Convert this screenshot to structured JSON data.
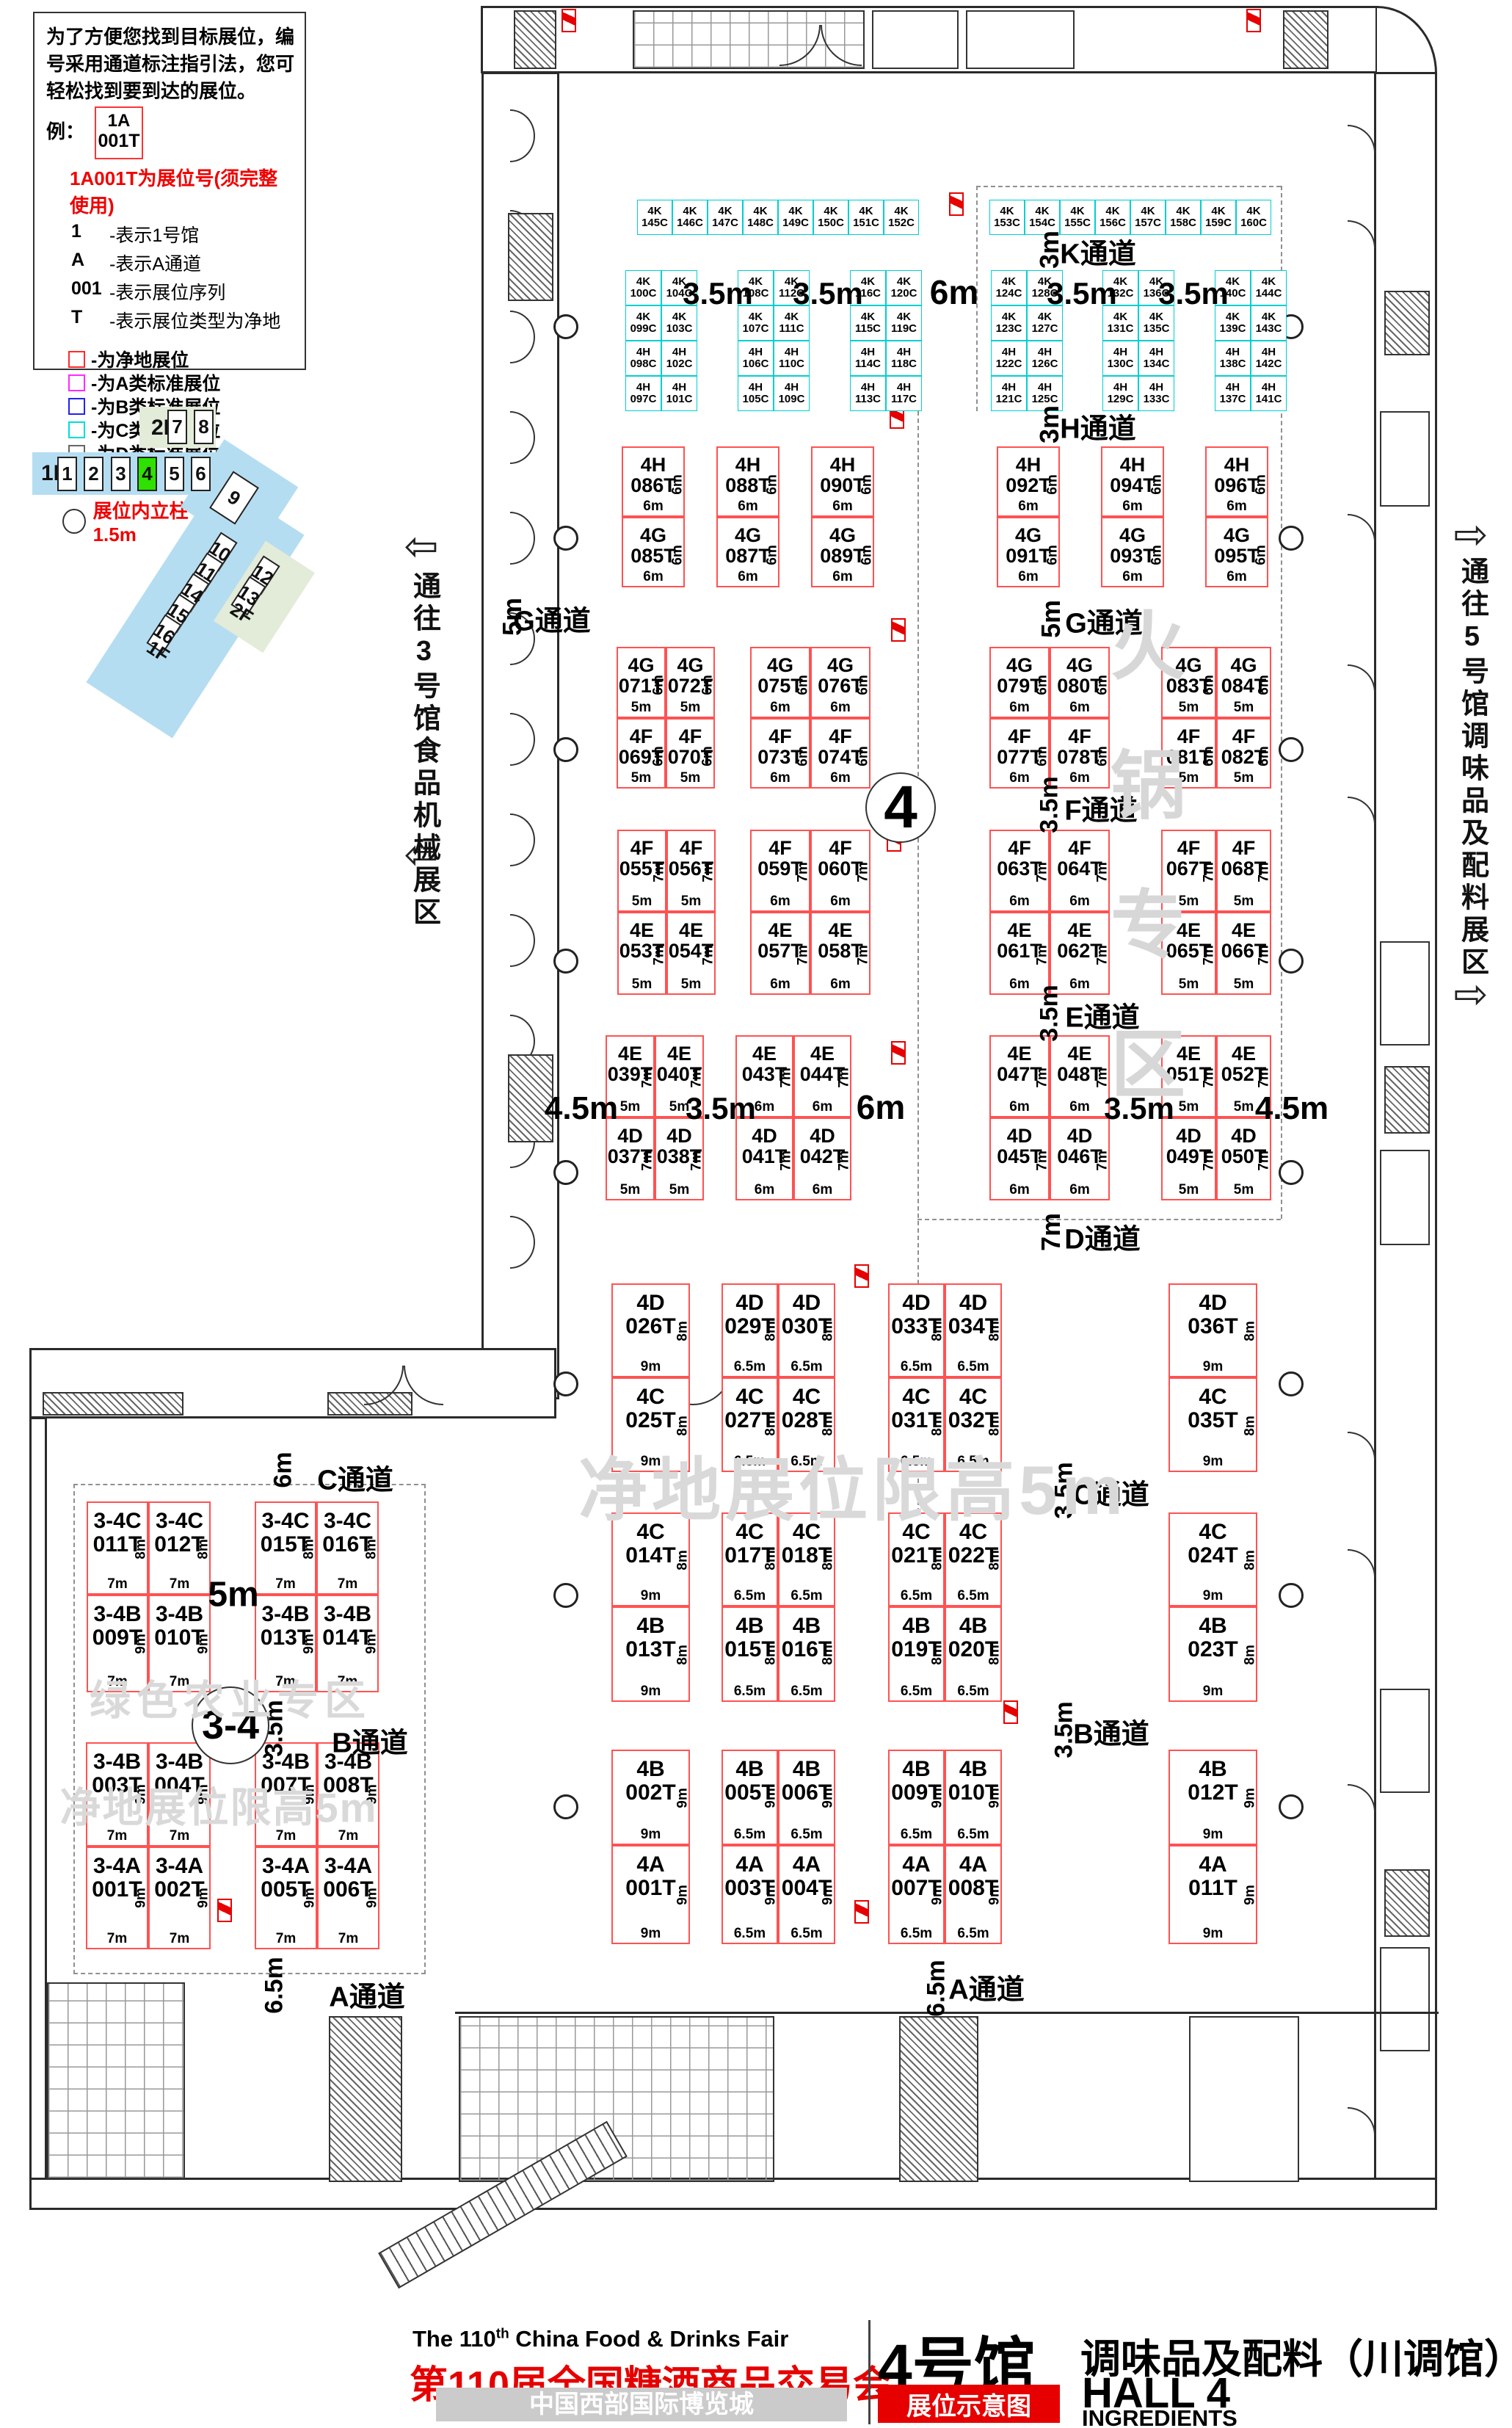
{
  "legend": {
    "intro": "为了方便您找到目标展位，编号采用通道标注指引法，您可轻松找到要到达的展位。",
    "example_label": "例：",
    "example_booth": {
      "line1": "1A",
      "line2": "001T"
    },
    "example_note": "1A001T为展位号(须完整使用)",
    "code_lines": [
      {
        "key": "1",
        "desc": "-表示1号馆"
      },
      {
        "key": "A",
        "desc": "-表示A通道"
      },
      {
        "key": "001",
        "desc": "-表示展位序列"
      },
      {
        "key": "T",
        "desc": "-表示展位类型为净地"
      }
    ],
    "type_items": [
      {
        "label": "-为净地展位",
        "color": "#ff2a2a"
      },
      {
        "label": "-为A类标准展位",
        "color": "#ff2aff"
      },
      {
        "label": "-为B类标准展位",
        "color": "#2222ee"
      },
      {
        "label": "-为C类标准展位",
        "color": "#00dcdc"
      },
      {
        "label": "-为D类标准展位",
        "color": "#666666"
      }
    ],
    "fire_note": "消防地井严禁遮挡",
    "pillar_note": "展位内立柱 直径均为1.5m"
  },
  "minimap": {
    "floor_1f": "1F",
    "floor_2f": "2F",
    "halls_row": [
      "1",
      "2",
      "3",
      "4",
      "5",
      "6"
    ],
    "highlighted_hall": "4",
    "halls_2f": [
      "7",
      "8"
    ],
    "hall_diag_large": "9",
    "halls_diag": [
      "10",
      "11",
      "14",
      "15",
      "16"
    ],
    "halls_diag_green": [
      "12",
      "13"
    ]
  },
  "nav": {
    "left_label": "通往3号馆食品机械展区",
    "right_label": "通往5号馆调味品及配料展区"
  },
  "plan": {
    "clusters": [
      {
        "id": "kL",
        "cells": [
          [
            "4K 145C",
            "4K 146C",
            "4K 147C",
            "4K 148C",
            "4K 149C",
            "4K 150C",
            "4K 151C",
            "4K 152C"
          ]
        ]
      },
      {
        "id": "kR",
        "cells": [
          [
            "4K 153C",
            "4K 154C",
            "4K 155C",
            "4K 156C",
            "4K 157C",
            "4K 158C",
            "4K 159C",
            "4K 160C"
          ]
        ]
      },
      {
        "id": "sA",
        "cells": [
          [
            "4K 100C",
            "4K 104C"
          ],
          [
            "4K 099C",
            "4K 103C"
          ],
          [
            "4H 098C",
            "4H 102C"
          ],
          [
            "4H 097C",
            "4H 101C"
          ]
        ]
      },
      {
        "id": "sB",
        "cells": [
          [
            "4K 108C",
            "4K 112C"
          ],
          [
            "4K 107C",
            "4K 111C"
          ],
          [
            "4H 106C",
            "4H 110C"
          ],
          [
            "4H 105C",
            "4H 109C"
          ]
        ]
      },
      {
        "id": "sC",
        "cells": [
          [
            "4K 116C",
            "4K 120C"
          ],
          [
            "4K 115C",
            "4K 119C"
          ],
          [
            "4H 114C",
            "4H 118C"
          ],
          [
            "4H 113C",
            "4H 117C"
          ]
        ]
      },
      {
        "id": "sD",
        "cells": [
          [
            "4K 124C",
            "4K 128C"
          ],
          [
            "4K 123C",
            "4K 127C"
          ],
          [
            "4H 122C",
            "4H 126C"
          ],
          [
            "4H 121C",
            "4H 125C"
          ]
        ]
      },
      {
        "id": "sE",
        "cells": [
          [
            "4K 132C",
            "4K 136C"
          ],
          [
            "4K 131C",
            "4K 135C"
          ],
          [
            "4H 130C",
            "4H 134C"
          ],
          [
            "4H 129C",
            "4H 133C"
          ]
        ]
      },
      {
        "id": "sF",
        "cells": [
          [
            "4K 140C",
            "4K 144C"
          ],
          [
            "4K 139C",
            "4K 143C"
          ],
          [
            "4H 138C",
            "4H 142C"
          ],
          [
            "4H 137C",
            "4H 141C"
          ]
        ]
      },
      {
        "id": "hg1",
        "cells": [
          [
            "4H 086T"
          ],
          [
            "4G 085T"
          ]
        ],
        "side": [
          "6m",
          "6m"
        ],
        "bottom": [
          "6m",
          "6m"
        ]
      },
      {
        "id": "hg2",
        "cells": [
          [
            "4H 088T"
          ],
          [
            "4G 087T"
          ]
        ],
        "side": [
          "6m",
          "6m"
        ],
        "bottom": [
          "6m",
          "6m"
        ]
      },
      {
        "id": "hg3",
        "cells": [
          [
            "4H 090T"
          ],
          [
            "4G 089T"
          ]
        ],
        "side": [
          "6m",
          "6m"
        ],
        "bottom": [
          "6m",
          "6m"
        ]
      },
      {
        "id": "hg4",
        "cells": [
          [
            "4H 092T"
          ],
          [
            "4G 091T"
          ]
        ],
        "side": [
          "6m",
          "6m"
        ],
        "bottom": [
          "6m",
          "6m"
        ]
      },
      {
        "id": "hg5",
        "cells": [
          [
            "4H 094T"
          ],
          [
            "4G 093T"
          ]
        ],
        "side": [
          "6m",
          "6m"
        ],
        "bottom": [
          "6m",
          "6m"
        ]
      },
      {
        "id": "hg6",
        "cells": [
          [
            "4H 096T"
          ],
          [
            "4G 095T"
          ]
        ],
        "side": [
          "6m",
          "6m"
        ],
        "bottom": [
          "6m",
          "6m"
        ]
      },
      {
        "id": "gf1",
        "cells": [
          [
            "4G 071T",
            "4G 072T"
          ],
          [
            "4F 069T",
            "4F 070T"
          ]
        ],
        "side": [
          "6m",
          "6m"
        ],
        "bottom": [
          "5m",
          "5m"
        ]
      },
      {
        "id": "gf2",
        "cells": [
          [
            "4G 075T",
            "4G 076T"
          ],
          [
            "4F 073T",
            "4F 074T"
          ]
        ],
        "side": [
          "6m",
          "6m"
        ],
        "bottom": [
          "6m",
          "6m"
        ]
      },
      {
        "id": "gf3",
        "cells": [
          [
            "4G 079T",
            "4G 080T"
          ],
          [
            "4F 077T",
            "4F 078T"
          ]
        ],
        "side": [
          "6m",
          "6m"
        ],
        "bottom": [
          "6m",
          "6m"
        ]
      },
      {
        "id": "gf4",
        "cells": [
          [
            "4G 083T",
            "4G 084T"
          ],
          [
            "4F 081T",
            "4F 082T"
          ]
        ],
        "side": [
          "6m",
          "6m"
        ],
        "bottom": [
          "5m",
          "5m"
        ]
      },
      {
        "id": "fe1",
        "cells": [
          [
            "4F 055T",
            "4F 056T"
          ],
          [
            "4E 053T",
            "4E 054T"
          ]
        ],
        "side": [
          "7m",
          "7m"
        ],
        "bottom": [
          "5m",
          "5m"
        ]
      },
      {
        "id": "fe2",
        "cells": [
          [
            "4F 059T",
            "4F 060T"
          ],
          [
            "4E 057T",
            "4E 058T"
          ]
        ],
        "side": [
          "7m",
          "7m"
        ],
        "bottom": [
          "6m",
          "6m"
        ]
      },
      {
        "id": "fe3",
        "cells": [
          [
            "4F 063T",
            "4F 064T"
          ],
          [
            "4E 061T",
            "4E 062T"
          ]
        ],
        "side": [
          "7m",
          "7m"
        ],
        "bottom": [
          "6m",
          "6m"
        ]
      },
      {
        "id": "fe4",
        "cells": [
          [
            "4F 067T",
            "4F 068T"
          ],
          [
            "4E 065T",
            "4E 066T"
          ]
        ],
        "side": [
          "7m",
          "7m"
        ],
        "bottom": [
          "5m",
          "5m"
        ]
      },
      {
        "id": "ed1",
        "cells": [
          [
            "4E 039T",
            "4E 040T"
          ],
          [
            "4D 037T",
            "4D 038T"
          ]
        ],
        "side": [
          "7m",
          "7m"
        ],
        "bottom": [
          "5m",
          "5m"
        ]
      },
      {
        "id": "ed2",
        "cells": [
          [
            "4E 043T",
            "4E 044T"
          ],
          [
            "4D 041T",
            "4D 042T"
          ]
        ],
        "side": [
          "7m",
          "7m"
        ],
        "bottom": [
          "6m",
          "6m"
        ]
      },
      {
        "id": "ed3",
        "cells": [
          [
            "4E 047T",
            "4E 048T"
          ],
          [
            "4D 045T",
            "4D 046T"
          ]
        ],
        "side": [
          "7m",
          "7m"
        ],
        "bottom": [
          "6m",
          "6m"
        ]
      },
      {
        "id": "ed4",
        "cells": [
          [
            "4E 051T",
            "4E 052T"
          ],
          [
            "4D 049T",
            "4D 050T"
          ]
        ],
        "side": [
          "7m",
          "7m"
        ],
        "bottom": [
          "5m",
          "5m"
        ]
      },
      {
        "id": "dc1",
        "cells": [
          [
            "4D 026T"
          ],
          [
            "4C 025T"
          ]
        ],
        "side": [
          "8m",
          "8m"
        ],
        "bottom": [
          "9m",
          "9m"
        ]
      },
      {
        "id": "dc2",
        "cells": [
          [
            "4D 029T",
            "4D 030T"
          ],
          [
            "4C 027T",
            "4C 028T"
          ]
        ],
        "side": [
          "8m",
          "8m"
        ],
        "bottom": [
          "6.5m",
          "6.5m"
        ]
      },
      {
        "id": "dc3",
        "cells": [
          [
            "4D 033T",
            "4D 034T"
          ],
          [
            "4C 031T",
            "4C 032T"
          ]
        ],
        "side": [
          "8m",
          "8m"
        ],
        "bottom": [
          "6.5m",
          "6.5m"
        ]
      },
      {
        "id": "dc4",
        "cells": [
          [
            "4D 036T"
          ],
          [
            "4C 035T"
          ]
        ],
        "side": [
          "8m",
          "8m"
        ],
        "bottom": [
          "9m",
          "9m"
        ]
      },
      {
        "id": "cb1",
        "cells": [
          [
            "4C 014T"
          ],
          [
            "4B 013T"
          ]
        ],
        "side": [
          "8m",
          "8m"
        ],
        "bottom": [
          "9m",
          "9m"
        ]
      },
      {
        "id": "cb2",
        "cells": [
          [
            "4C 017T",
            "4C 018T"
          ],
          [
            "4B 015T",
            "4B 016T"
          ]
        ],
        "side": [
          "8m",
          "8m"
        ],
        "bottom": [
          "6.5m",
          "6.5m"
        ]
      },
      {
        "id": "cb3",
        "cells": [
          [
            "4C 021T",
            "4C 022T"
          ],
          [
            "4B 019T",
            "4B 020T"
          ]
        ],
        "side": [
          "8m",
          "8m"
        ],
        "bottom": [
          "6.5m",
          "6.5m"
        ]
      },
      {
        "id": "cb4",
        "cells": [
          [
            "4C 024T"
          ],
          [
            "4B 023T"
          ]
        ],
        "side": [
          "8m",
          "8m"
        ],
        "bottom": [
          "9m",
          "9m"
        ]
      },
      {
        "id": "ba1",
        "cells": [
          [
            "4B 002T"
          ],
          [
            "4A 001T"
          ]
        ],
        "side": [
          "9m",
          "9m"
        ],
        "bottom": [
          "9m",
          "9m"
        ]
      },
      {
        "id": "ba2",
        "cells": [
          [
            "4B 005T",
            "4B 006T"
          ],
          [
            "4A 003T",
            "4A 004T"
          ]
        ],
        "side": [
          "9m",
          "9m"
        ],
        "bottom": [
          "6.5m",
          "6.5m"
        ]
      },
      {
        "id": "ba3",
        "cells": [
          [
            "4B 009T",
            "4B 010T"
          ],
          [
            "4A 007T",
            "4A 008T"
          ]
        ],
        "side": [
          "9m",
          "9m"
        ],
        "bottom": [
          "6.5m",
          "6.5m"
        ]
      },
      {
        "id": "ba4",
        "cells": [
          [
            "4B 012T"
          ],
          [
            "4A 011T"
          ]
        ],
        "side": [
          "9m",
          "9m"
        ],
        "bottom": [
          "9m",
          "9m"
        ]
      },
      {
        "id": "w1",
        "cells": [
          [
            "3-4C 011T",
            "3-4C 012T"
          ],
          [
            "3-4B 009T",
            "3-4B 010T"
          ]
        ],
        "side": [
          "8m",
          "9m"
        ],
        "bottom": [
          "7m",
          "7m"
        ]
      },
      {
        "id": "w2",
        "cells": [
          [
            "3-4C 015T",
            "3-4C 016T"
          ],
          [
            "3-4B 013T",
            "3-4B 014T"
          ]
        ],
        "side": [
          "8m",
          "9m"
        ],
        "bottom": [
          "7m",
          "7m"
        ]
      },
      {
        "id": "w3",
        "cells": [
          [
            "3-4B 003T",
            "3-4B 004T"
          ],
          [
            "3-4A 001T",
            "3-4A 002T"
          ]
        ],
        "side": [
          "9m",
          "9m"
        ],
        "bottom": [
          "7m",
          "7m"
        ]
      },
      {
        "id": "w4",
        "cells": [
          [
            "3-4B 007T",
            "3-4B 008T"
          ],
          [
            "3-4A 005T",
            "3-4A 006T"
          ]
        ],
        "side": [
          "9m",
          "9m"
        ],
        "bottom": [
          "7m",
          "7m"
        ]
      }
    ],
    "labels": [
      {
        "id": "aisle-k",
        "text": "K通道"
      },
      {
        "id": "dim-k",
        "text": "3m"
      },
      {
        "id": "aisle-h",
        "text": "H通道"
      },
      {
        "id": "dim-h",
        "text": "3m"
      },
      {
        "id": "aisle-g-left",
        "text": "G通道"
      },
      {
        "id": "dim-g-left",
        "text": "5m"
      },
      {
        "id": "aisle-g-right",
        "text": "G通道"
      },
      {
        "id": "dim-g-right",
        "text": "5m"
      },
      {
        "id": "aisle-f",
        "text": "F通道"
      },
      {
        "id": "dim-f",
        "text": "3.5m"
      },
      {
        "id": "aisle-e",
        "text": "E通道"
      },
      {
        "id": "dim-e",
        "text": "3.5m"
      },
      {
        "id": "aisle-d",
        "text": "D通道"
      },
      {
        "id": "dim-d",
        "text": "7m"
      },
      {
        "id": "aisle-c-right",
        "text": "C通道"
      },
      {
        "id": "dim-c-right",
        "text": "3.5m"
      },
      {
        "id": "aisle-b-right",
        "text": "B通道"
      },
      {
        "id": "dim-b-right",
        "text": "3.5m"
      },
      {
        "id": "aisle-a-right",
        "text": "A通道"
      },
      {
        "id": "dim-a-right",
        "text": "6.5m"
      },
      {
        "id": "aisle-c-wing",
        "text": "C通道"
      },
      {
        "id": "dim-c-wing",
        "text": "6m"
      },
      {
        "id": "aisle-b-wing",
        "text": "B通道"
      },
      {
        "id": "dim-b-wing",
        "text": "3.5m"
      },
      {
        "id": "aisle-a-wing",
        "text": "A通道"
      },
      {
        "id": "dim-a-wing",
        "text": "6.5m"
      },
      {
        "id": "gap-1",
        "text": "3.5m"
      },
      {
        "id": "gap-2",
        "text": "3.5m"
      },
      {
        "id": "gap-3",
        "text": "6m"
      },
      {
        "id": "gap-4",
        "text": "3.5m"
      },
      {
        "id": "gap-5",
        "text": "3.5m"
      },
      {
        "id": "gap-6",
        "text": "4.5m"
      },
      {
        "id": "gap-7",
        "text": "3.5m"
      },
      {
        "id": "gap-8",
        "text": "6m"
      },
      {
        "id": "gap-9",
        "text": "3.5m"
      },
      {
        "id": "gap-10",
        "text": "4.5m"
      },
      {
        "id": "wing-5m",
        "text": "5m"
      },
      {
        "id": "zone-4",
        "text": "4"
      },
      {
        "id": "zone-34",
        "text": "3-4"
      },
      {
        "id": "wm-hotpot",
        "text": "火锅专区"
      },
      {
        "id": "wm-height-main",
        "text": "净地展位限高5m"
      },
      {
        "id": "wm-green",
        "text": "绿色农业专区"
      },
      {
        "id": "wm-height-wing",
        "text": "净地展位限高5m"
      },
      {
        "id": "arrow-left-top",
        "text": "⇦"
      },
      {
        "id": "arrow-left-bottom",
        "text": "⇦"
      },
      {
        "id": "arrow-right-top",
        "text": "⇨"
      },
      {
        "id": "arrow-right-bottom",
        "text": "⇨"
      }
    ]
  },
  "title_block": {
    "en_title_head": "The 110",
    "en_title_sup": "th",
    "en_title_tail": " China Food & Drinks Fair",
    "cn_title": "第110届全国糖酒商品交易会",
    "venue": "中国西部国际博览城",
    "hall_cn": "4号馆",
    "hall_desc": "调味品及配料（川调馆）",
    "hall_en": "HALL 4",
    "map_tag": "展位示意图",
    "hall_en_sub": "INGREDIENTS"
  },
  "colors": {
    "booth_open": "#ff5252",
    "booth_type_c": "#00cfcf",
    "accent_red": "#e60000",
    "minimap_blue": "#b5ddf1",
    "minimap_green_hall": "#2fe100",
    "minimap_lightgreen": "#e3ebd9",
    "watermark_gray": "#d8d8d8"
  }
}
